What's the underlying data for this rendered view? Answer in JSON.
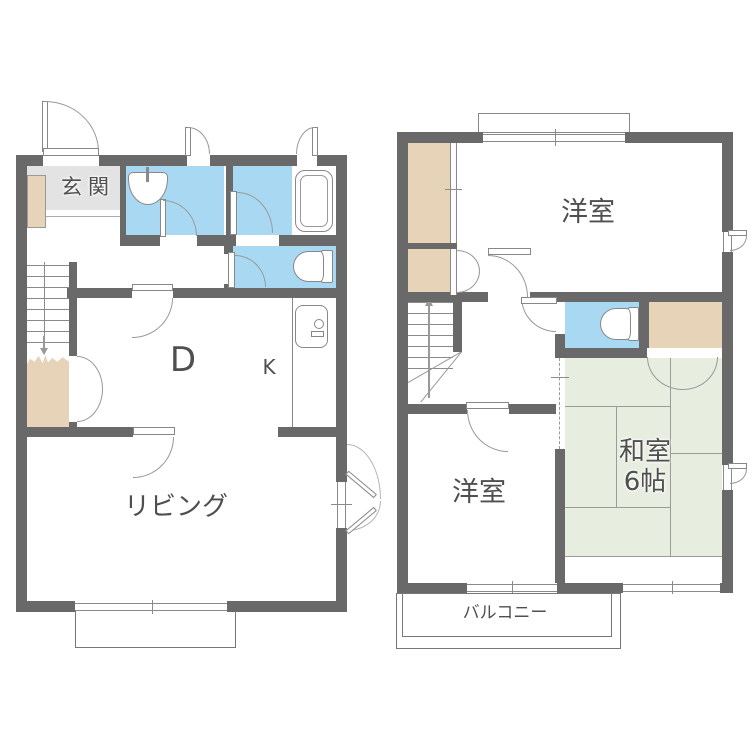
{
  "document_type": "floor-plan",
  "colors": {
    "wall": "#696969",
    "water_room_blue": "#a9d9f2",
    "closet_beige": "#e6d3b8",
    "entry_gray": "#e3e3e3",
    "tatami_green": "#e7eee0",
    "line_gray": "#8a8a8a",
    "text_gray": "#4f4f4f"
  },
  "floor1": {
    "labels": {
      "entry": "玄関",
      "dining": "D",
      "kitchen": "K",
      "living": "リビング"
    }
  },
  "floor2": {
    "labels": {
      "bedroom_top": "洋室",
      "bedroom_bottom": "洋室",
      "tatami_name": "和室",
      "tatami_size": "6帖",
      "balcony": "バルコニー"
    }
  }
}
